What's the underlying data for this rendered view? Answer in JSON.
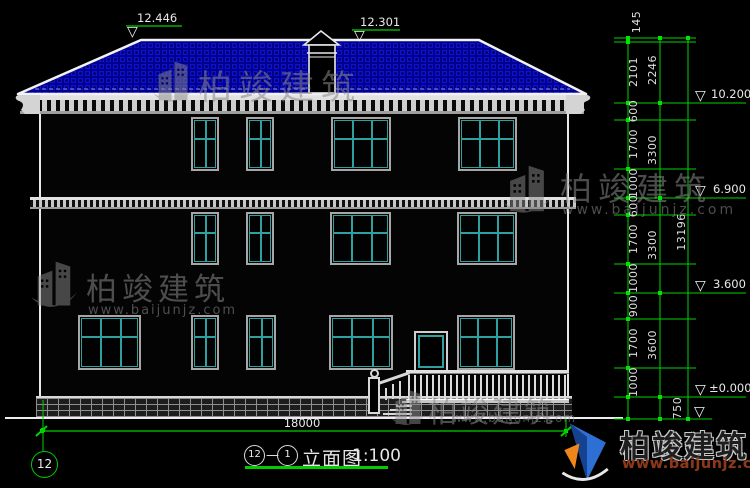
{
  "drawing": {
    "title": {
      "bubble_left": "12",
      "connector": "—",
      "bubble_right": "1",
      "name": "立面图",
      "scale": "1:100"
    },
    "grid_bubble": "12",
    "width_dim": "18000",
    "elevation_marks": {
      "ridge_left": "12.446",
      "ridge_right": "12.301",
      "eave": "10.200",
      "level2": "6.900",
      "level1": "3.600",
      "ground": "±0.000"
    },
    "dims": {
      "inner": [
        "145",
        "2101",
        "600",
        "1700",
        "1000",
        "600",
        "1700",
        "1000",
        "900",
        "1700",
        "1000"
      ],
      "outer": [
        "2246",
        "3300",
        "3300",
        "3600"
      ],
      "base": "750",
      "total": "13196"
    }
  },
  "watermark": {
    "brand": "柏竣建筑",
    "url": "www.baijunjz.com"
  },
  "logo": {
    "brand": "柏竣建筑",
    "url": "www.baijunjz.com"
  },
  "colors": {
    "dim_green": "#00d200",
    "window_teal": "#2fa0a0",
    "roof_blue": "#00008e",
    "logo_blue": "#2d6fd2",
    "logo_orange": "#f08519"
  }
}
